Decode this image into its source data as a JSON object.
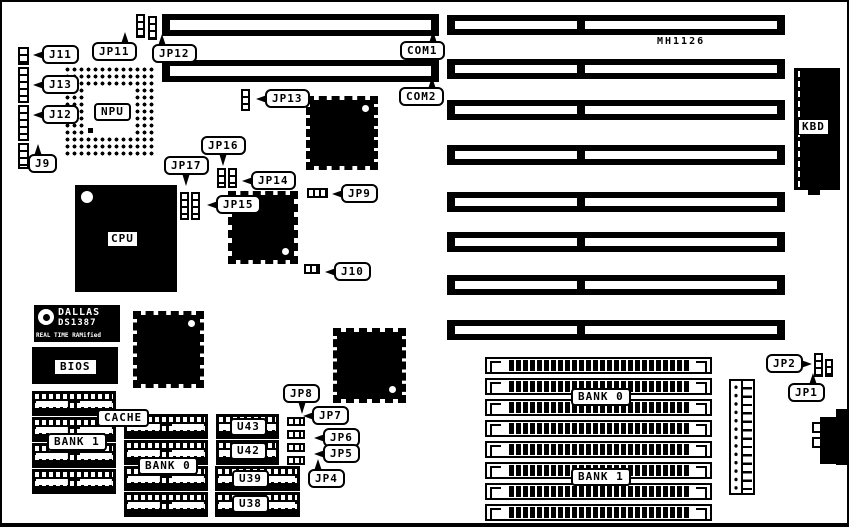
{
  "title": "MH1126 motherboard layout diagram",
  "silkscreen": {
    "model": "MH1126"
  },
  "chips": {
    "npu": "NPU",
    "cpu": "CPU",
    "bios": "BIOS",
    "kbd": "KBD",
    "dallas_line1": "DALLAS",
    "dallas_line2": "DS1387",
    "dallas_line3": "REAL TIME RAMified"
  },
  "memory": {
    "cache": "CACHE",
    "bank1_dip": "BANK 1",
    "bank0_dip": "BANK 0",
    "bank0_simm": "BANK 0",
    "bank1_simm": "BANK 1",
    "u_chips": [
      "U43",
      "U42",
      "U39",
      "U38"
    ]
  },
  "connectors": {
    "com1": "COM1",
    "com2": "COM2",
    "j9": "J9",
    "j10": "J10",
    "j11": "J11",
    "j12": "J12",
    "j13": "J13"
  },
  "jumpers": {
    "jp1": "JP1",
    "jp2": "JP2",
    "jp4": "JP4",
    "jp5": "JP5",
    "jp6": "JP6",
    "jp7": "JP7",
    "jp8": "JP8",
    "jp9": "JP9",
    "jp11": "JP11",
    "jp12": "JP12",
    "jp13": "JP13",
    "jp14": "JP14",
    "jp15": "JP15",
    "jp16": "JP16",
    "jp17": "JP17"
  },
  "counts": {
    "isa_slots": 8,
    "simm_sockets": 8
  },
  "colors": {
    "ink": "#000000",
    "background": "#ffffff"
  }
}
